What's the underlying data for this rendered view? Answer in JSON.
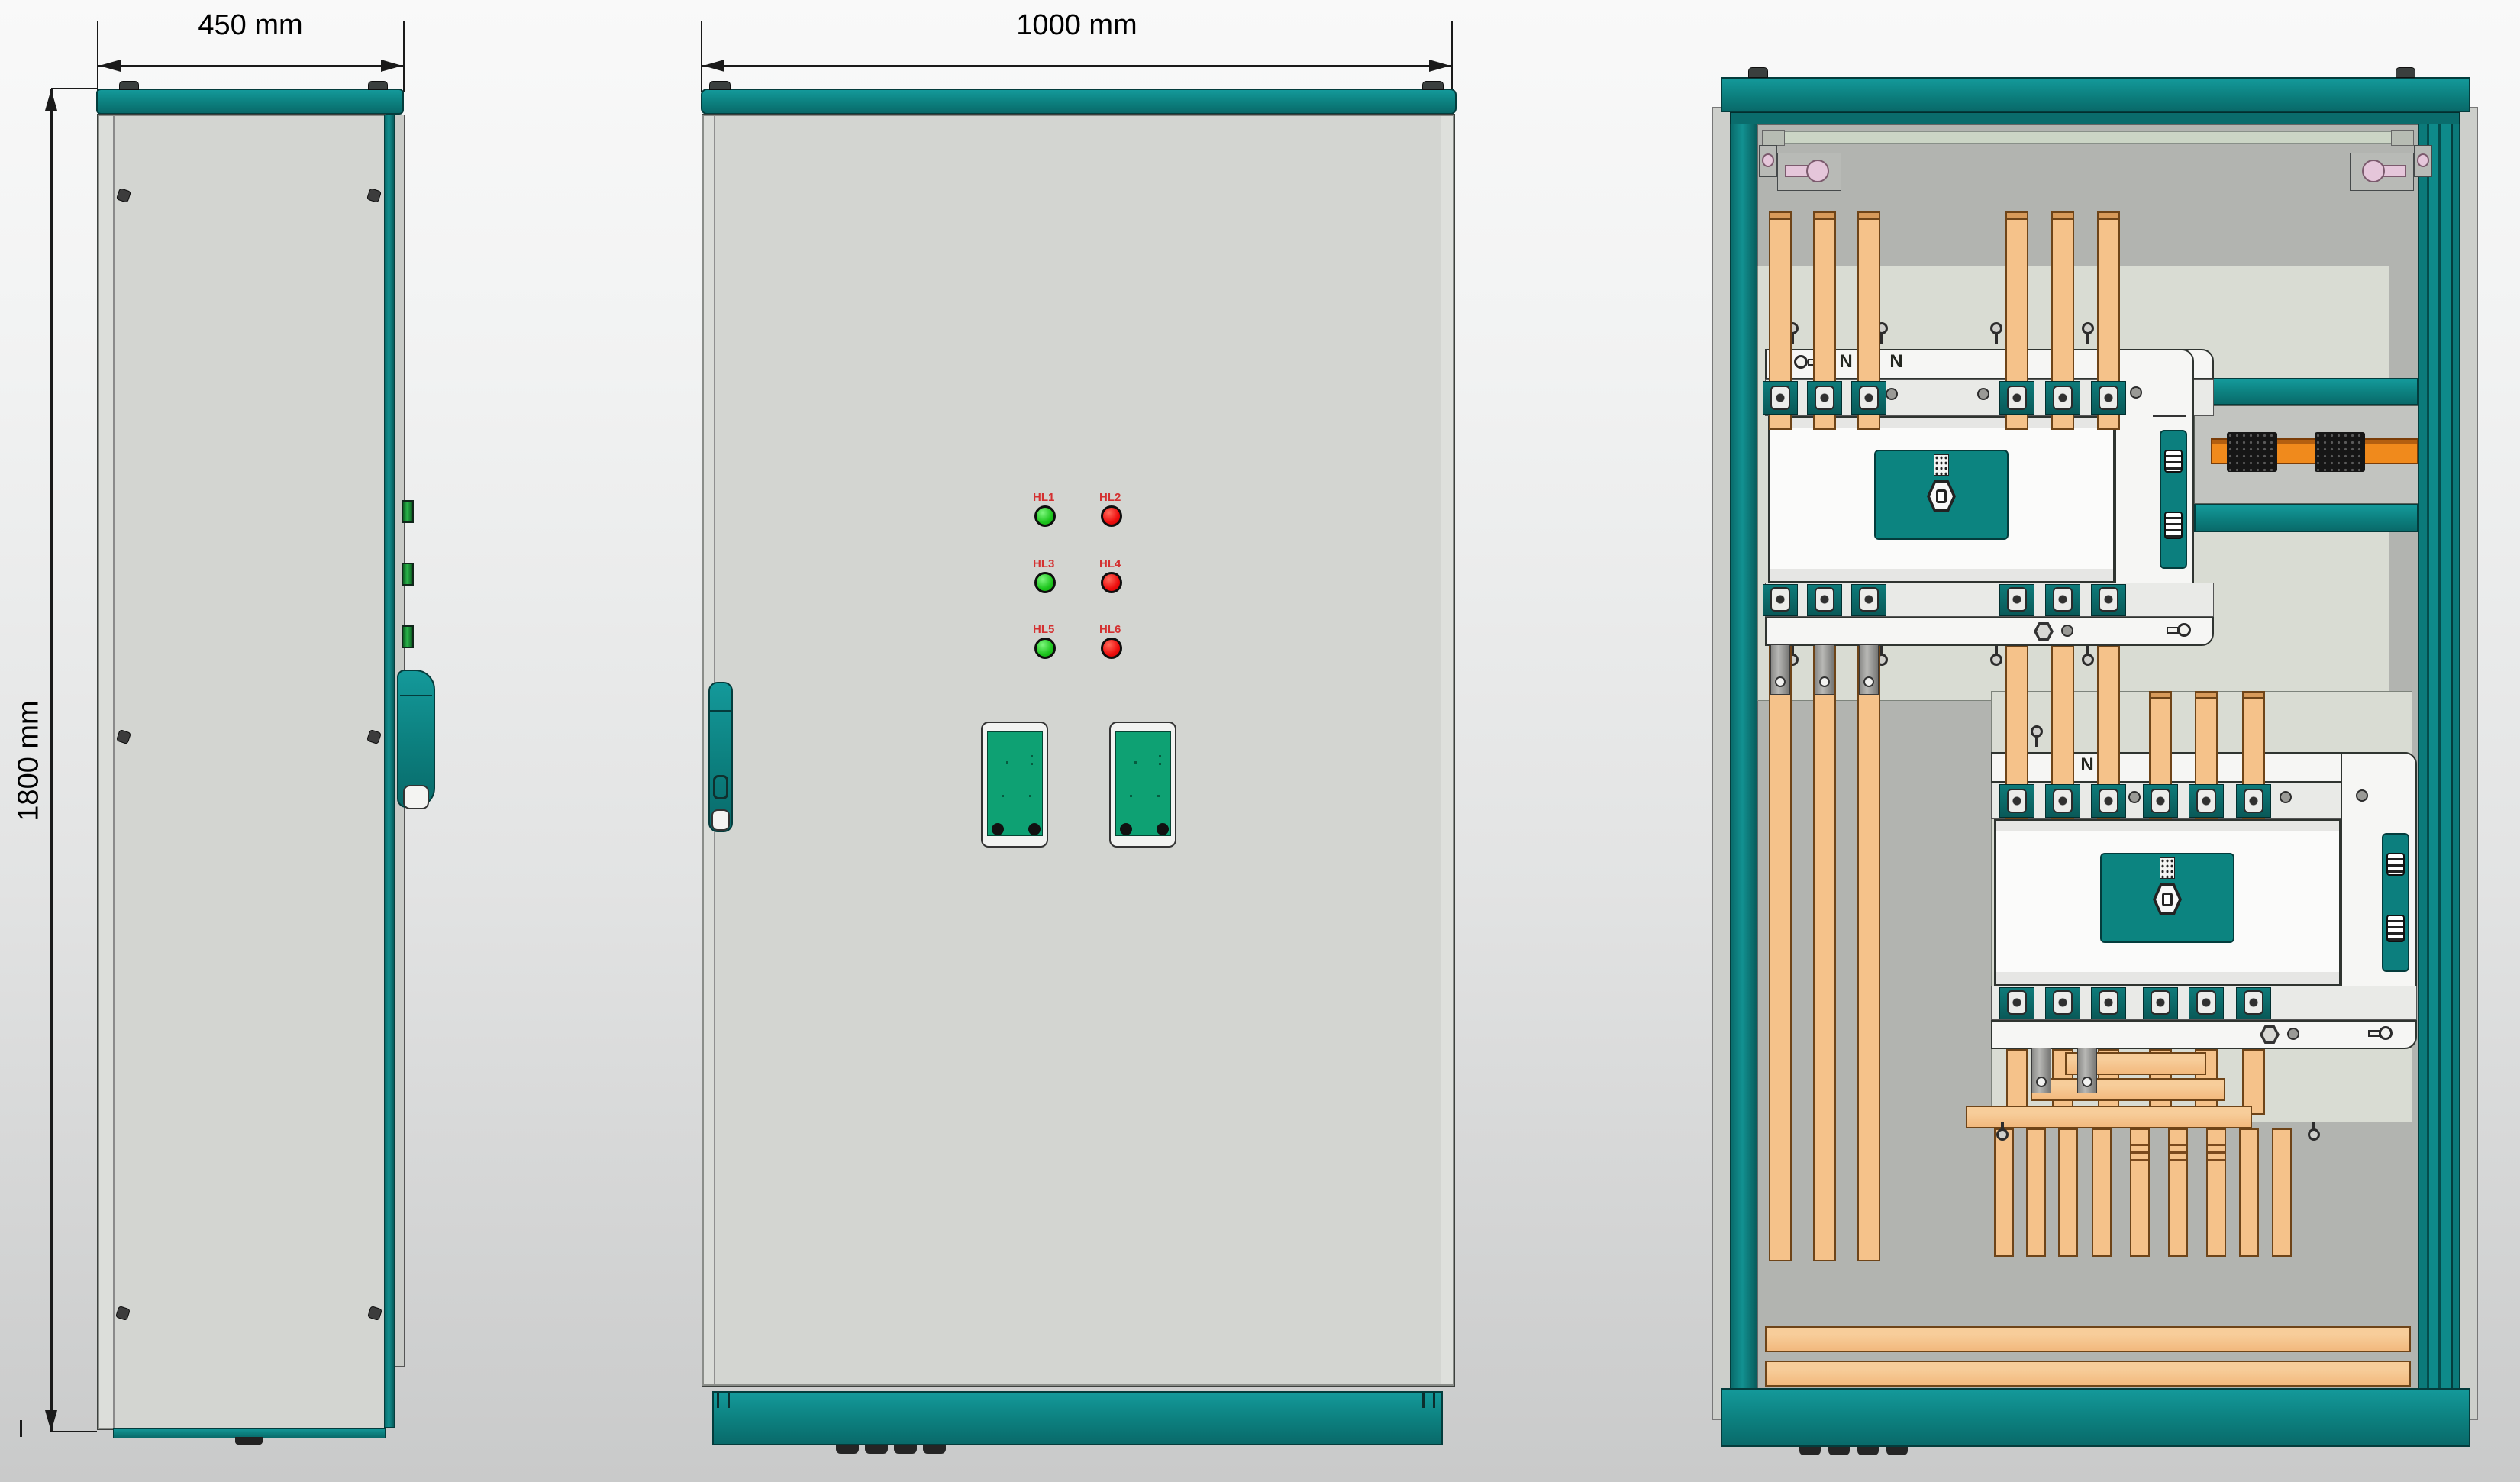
{
  "dimensions": {
    "side_width": "450 mm",
    "front_width": "1000 mm",
    "cabinet_height": "1800 mm"
  },
  "front_view": {
    "indicators": [
      {
        "id": "HL1",
        "color": "green"
      },
      {
        "id": "HL2",
        "color": "red"
      },
      {
        "id": "HL3",
        "color": "green"
      },
      {
        "id": "HL4",
        "color": "red"
      },
      {
        "id": "HL5",
        "color": "green"
      },
      {
        "id": "HL6",
        "color": "red"
      }
    ]
  },
  "internal_view": {
    "upper_switch_labels": [
      "N",
      "N",
      "N"
    ],
    "lower_switch_labels": [
      "N",
      "N"
    ]
  },
  "colors": {
    "frame_teal": "#0c7f7e",
    "panel_gray": "#d3d5d1",
    "backplate_gray": "#b2b4b0",
    "mounting_plate": "#d9dcd3",
    "busbar_copper": "#f5c28a",
    "din_rail_orange": "#ef8619",
    "indicator_green": "#1dc51d",
    "indicator_red": "#ee0d0d",
    "indicator_label_red": "#d43030",
    "device_green": "#0ea173",
    "hinge_green": "#2ab44a",
    "fitting_pink": "#e5c6da"
  }
}
